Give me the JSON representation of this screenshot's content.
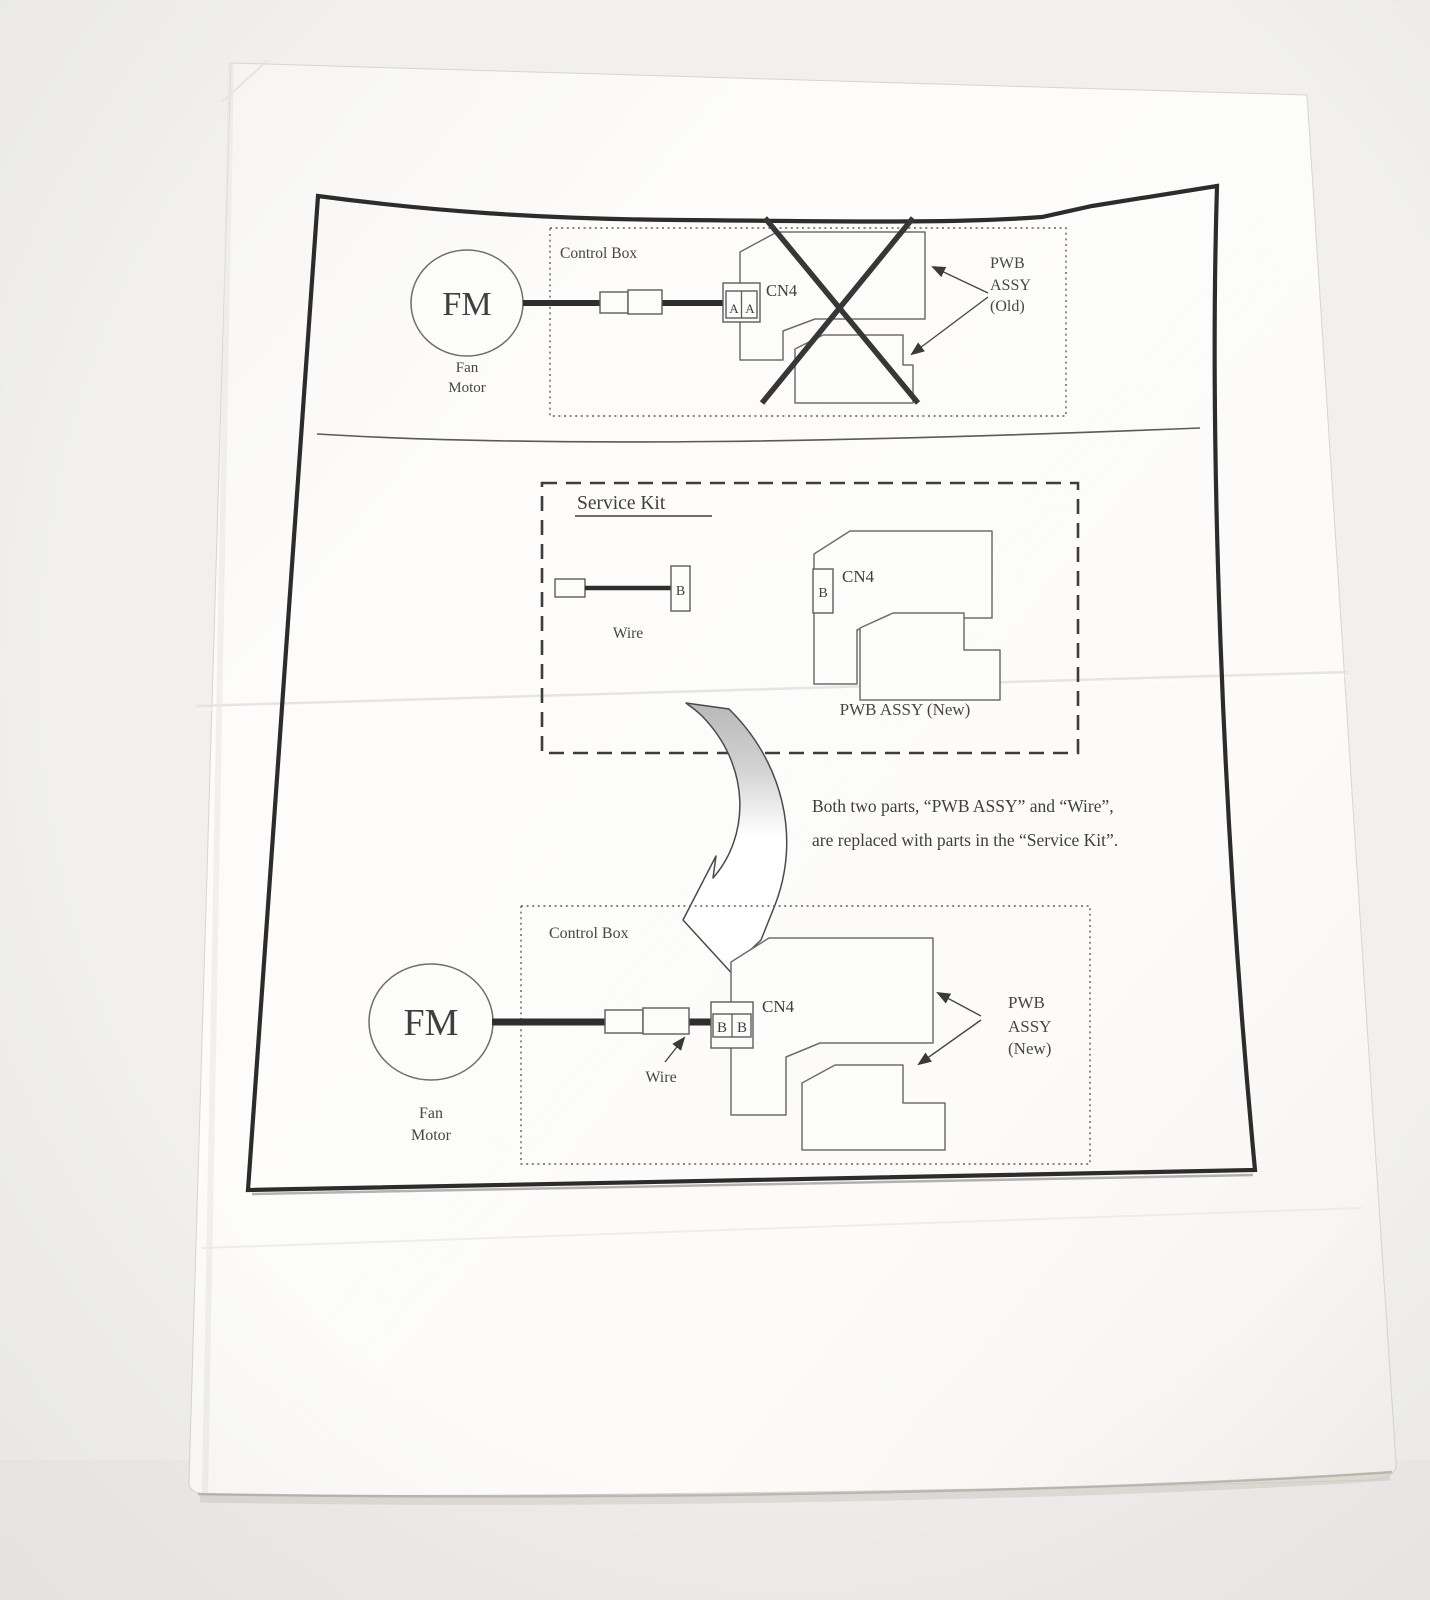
{
  "old_section": {
    "control_box_label": "Control Box",
    "fm_label": "FM",
    "fan_motor_line1": "Fan",
    "fan_motor_line2": "Motor",
    "connector_cell1": "A",
    "connector_cell2": "A",
    "cn4_label": "CN4",
    "pwb_line1": "PWB",
    "pwb_line2": "ASSY",
    "pwb_line3": "(Old)"
  },
  "service_kit": {
    "title": "Service Kit",
    "wire_connector_letter": "B",
    "wire_label": "Wire",
    "pwb_connector_letter": "B",
    "cn4_label": "CN4",
    "pwb_label": "PWB ASSY (New)"
  },
  "note": {
    "line1": "Both two parts, “PWB ASSY” and “Wire”,",
    "line2": "are replaced with parts in the “Service Kit”."
  },
  "new_section": {
    "control_box_label": "Control Box",
    "fm_label": "FM",
    "fan_motor_line1": "Fan",
    "fan_motor_line2": "Motor",
    "connector_cell1": "B",
    "connector_cell2": "B",
    "cn4_label": "CN4",
    "wire_label": "Wire",
    "pwb_line1": "PWB",
    "pwb_line2": "ASSY",
    "pwb_line3": "(New)"
  },
  "colors": {
    "ink": "#3a3a3a",
    "outline": "#6e6e6e",
    "paper": "#fcfbf9",
    "backdrop": "#f1f0ee",
    "arrow_shade": "#bdbdbd"
  }
}
